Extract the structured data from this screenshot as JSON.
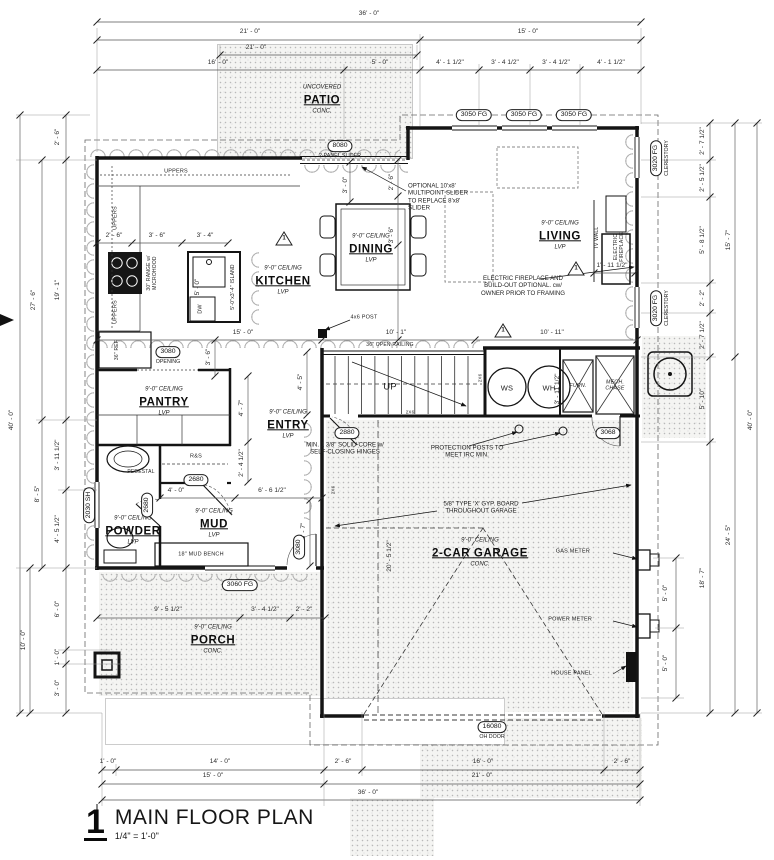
{
  "title_block": {
    "number": "1",
    "title": "MAIN FLOOR PLAN",
    "scale": "1/4\" = 1'-0\""
  },
  "plan": {
    "rooms": [
      {
        "id": "patio",
        "pre": "UNCOVERED",
        "label": "PATIO",
        "sub": "CONC.",
        "x": 322,
        "y": 100
      },
      {
        "id": "kitchen",
        "pre": "9'-0\" CEILING",
        "label": "KITCHEN",
        "sub": "LVP",
        "x": 283,
        "y": 281
      },
      {
        "id": "dining",
        "pre": "9'-0\" CEILING",
        "label": "DINING",
        "sub": "LVP",
        "x": 371,
        "y": 249
      },
      {
        "id": "living",
        "pre": "9'-0\" CEILING",
        "label": "LIVING",
        "sub": "LVP",
        "x": 560,
        "y": 236
      },
      {
        "id": "pantry",
        "pre": "9'-0\" CEILING",
        "label": "PANTRY",
        "sub": "LVP",
        "x": 164,
        "y": 402
      },
      {
        "id": "entry",
        "pre": "9'-0\" CEILING",
        "label": "ENTRY",
        "sub": "LVP",
        "x": 288,
        "y": 425
      },
      {
        "id": "powder",
        "pre": "9'-0\" CEILING",
        "label": "POWDER",
        "sub": "LVP",
        "x": 133,
        "y": 531
      },
      {
        "id": "mud",
        "pre": "9'-0\" CEILING",
        "label": "MUD",
        "sub": "LVP",
        "x": 214,
        "y": 524
      },
      {
        "id": "garage",
        "pre": "9'-0\" CEILING",
        "label": "2-CAR GARAGE",
        "sub": "CONC.",
        "x": 480,
        "y": 553
      },
      {
        "id": "porch",
        "pre": "9'-0\" CEILING",
        "label": "PORCH",
        "sub": "CONC.",
        "x": 213,
        "y": 640
      }
    ],
    "dimensions": [
      {
        "t": "36' - 0\"",
        "x": 369,
        "y": 14
      },
      {
        "t": "21' - 0\"",
        "x": 250,
        "y": 32
      },
      {
        "t": "15' - 0\"",
        "x": 528,
        "y": 32
      },
      {
        "t": "21' - 0\"",
        "x": 256,
        "y": 48
      },
      {
        "t": "16' - 0\"",
        "x": 218,
        "y": 63
      },
      {
        "t": "5' - 0\"",
        "x": 380,
        "y": 63
      },
      {
        "t": "4' - 1 1/2\"",
        "x": 450,
        "y": 63
      },
      {
        "t": "3' - 4 1/2\"",
        "x": 505,
        "y": 63
      },
      {
        "t": "3' - 4 1/2\"",
        "x": 556,
        "y": 63
      },
      {
        "t": "4' - 1 1/2\"",
        "x": 611,
        "y": 63
      },
      {
        "t": "1' - 0\"",
        "x": 108,
        "y": 762
      },
      {
        "t": "14' - 0\"",
        "x": 220,
        "y": 762
      },
      {
        "t": "2' - 6\"",
        "x": 343,
        "y": 762
      },
      {
        "t": "16' - 0\"",
        "x": 483,
        "y": 762
      },
      {
        "t": "2' - 6\"",
        "x": 622,
        "y": 762
      },
      {
        "t": "15' - 0\"",
        "x": 213,
        "y": 776
      },
      {
        "t": "21' - 0\"",
        "x": 482,
        "y": 776
      },
      {
        "t": "36' - 0\"",
        "x": 368,
        "y": 793
      },
      {
        "t": "2' - 6\"",
        "x": 58,
        "y": 137,
        "r": 1
      },
      {
        "t": "19' - 1\"",
        "x": 58,
        "y": 290,
        "r": 1
      },
      {
        "t": "27' - 6\"",
        "x": 34,
        "y": 300,
        "r": 1
      },
      {
        "t": "40' - 0\"",
        "x": 12,
        "y": 420,
        "r": 1
      },
      {
        "t": "3' - 11 1/2\"",
        "x": 58,
        "y": 455,
        "r": 1
      },
      {
        "t": "8' - 5\"",
        "x": 38,
        "y": 494,
        "r": 1
      },
      {
        "t": "4' - 5 1/2\"",
        "x": 58,
        "y": 529,
        "r": 1
      },
      {
        "t": "6' - 0\"",
        "x": 58,
        "y": 609,
        "r": 1
      },
      {
        "t": "1' - 0\"",
        "x": 58,
        "y": 657,
        "r": 1
      },
      {
        "t": "3' - 0\"",
        "x": 58,
        "y": 688,
        "r": 1
      },
      {
        "t": "10' - 0\"",
        "x": 24,
        "y": 640,
        "r": 1
      },
      {
        "t": "2' - 7 1/2\"",
        "x": 703,
        "y": 141,
        "r": 1
      },
      {
        "t": "2' - 5 1/2\"",
        "x": 703,
        "y": 178,
        "r": 1
      },
      {
        "t": "5' - 8 1/2\"",
        "x": 703,
        "y": 240,
        "r": 1
      },
      {
        "t": "2' - 2\"",
        "x": 703,
        "y": 298,
        "r": 1
      },
      {
        "t": "2' - 7 1/2\"",
        "x": 703,
        "y": 335,
        "r": 1
      },
      {
        "t": "15' - 7\"",
        "x": 729,
        "y": 240,
        "r": 1
      },
      {
        "t": "5' - 10\"",
        "x": 703,
        "y": 399,
        "r": 1
      },
      {
        "t": "18' - 7\"",
        "x": 703,
        "y": 578,
        "r": 1
      },
      {
        "t": "24' - 5\"",
        "x": 729,
        "y": 535,
        "r": 1
      },
      {
        "t": "40' - 0\"",
        "x": 751,
        "y": 420,
        "r": 1
      },
      {
        "t": "5' - 0\"",
        "x": 666,
        "y": 593,
        "r": 1
      },
      {
        "t": "5' - 0\"",
        "x": 666,
        "y": 663,
        "r": 1
      },
      {
        "t": "2' - 6\"",
        "x": 114,
        "y": 236
      },
      {
        "t": "3' - 6\"",
        "x": 157,
        "y": 236
      },
      {
        "t": "3' - 4\"",
        "x": 205,
        "y": 236
      },
      {
        "t": "5' - 0\"",
        "x": 198,
        "y": 287,
        "r": 1
      },
      {
        "t": "15' - 0\"",
        "x": 243,
        "y": 333
      },
      {
        "t": "10' - 1\"",
        "x": 396,
        "y": 333
      },
      {
        "t": "10' - 11\"",
        "x": 552,
        "y": 333
      },
      {
        "t": "3' - 6\"",
        "x": 209,
        "y": 357,
        "r": 1
      },
      {
        "t": "2' - 6\"",
        "x": 392,
        "y": 182,
        "r": 1
      },
      {
        "t": "3' - 6\"",
        "x": 392,
        "y": 235,
        "r": 1
      },
      {
        "t": "3' - 0\"",
        "x": 346,
        "y": 185,
        "r": 1
      },
      {
        "t": "4' - 7\"",
        "x": 242,
        "y": 408,
        "r": 1
      },
      {
        "t": "2' - 4 1/2\"",
        "x": 242,
        "y": 463,
        "r": 1
      },
      {
        "t": "4' - 5\"",
        "x": 301,
        "y": 382,
        "r": 1
      },
      {
        "t": "4' - 0\"",
        "x": 176,
        "y": 491
      },
      {
        "t": "6' - 6 1/2\"",
        "x": 272,
        "y": 491
      },
      {
        "t": "5' - 7\"",
        "x": 304,
        "y": 531,
        "r": 1
      },
      {
        "t": "1' - 11 1/2\"",
        "x": 612,
        "y": 266
      },
      {
        "t": "3' - 11 1/2\"",
        "x": 558,
        "y": 389,
        "r": 1
      },
      {
        "t": "20' - 5 1/2\"",
        "x": 390,
        "y": 556,
        "r": 1
      },
      {
        "t": "9' - 5 1/2\"",
        "x": 168,
        "y": 610
      },
      {
        "t": "3' - 4 1/2\"",
        "x": 265,
        "y": 610
      },
      {
        "t": "2' - 2\"",
        "x": 304,
        "y": 610
      }
    ],
    "tags": [
      {
        "t": "8080",
        "sub": "2-PANEL SLIDER",
        "x": 340,
        "y": 146
      },
      {
        "t": "3050 FG",
        "x": 474,
        "y": 115
      },
      {
        "t": "3050 FG",
        "x": 524,
        "y": 115
      },
      {
        "t": "3050 FG",
        "x": 574,
        "y": 115
      },
      {
        "t": "3020 FG",
        "sub": "CLERESTORY",
        "x": 656,
        "y": 158,
        "r": 1
      },
      {
        "t": "3020 FG",
        "sub": "CLERESTORY",
        "x": 656,
        "y": 308,
        "r": 1
      },
      {
        "t": "3080",
        "sub": "OPENING",
        "x": 168,
        "y": 352
      },
      {
        "t": "2880",
        "x": 347,
        "y": 433
      },
      {
        "t": "3068",
        "x": 608,
        "y": 433
      },
      {
        "t": "2680",
        "x": 196,
        "y": 480
      },
      {
        "t": "2680",
        "x": 147,
        "y": 505,
        "r": 1
      },
      {
        "t": "2030 SH",
        "x": 89,
        "y": 505,
        "r": 1
      },
      {
        "t": "3060 FG",
        "x": 240,
        "y": 585
      },
      {
        "t": "3080",
        "x": 299,
        "y": 547,
        "r": 1
      },
      {
        "t": "16080",
        "sub": "OH DOOR",
        "x": 492,
        "y": 727
      }
    ],
    "fixtures": [
      {
        "t": "UPPERS",
        "x": 176,
        "y": 172,
        "fs": 5.5
      },
      {
        "t": "UPPERS",
        "x": 116,
        "y": 218,
        "r": 1,
        "fs": 5.5
      },
      {
        "t": "UPPERS",
        "x": 116,
        "y": 312,
        "r": 1,
        "fs": 5.5
      },
      {
        "t": "30\" RANGE w/\nMICROHOOD",
        "x": 152,
        "y": 273,
        "r": 1,
        "fs": 5
      },
      {
        "t": "DW",
        "x": 201,
        "y": 309,
        "r": 1,
        "fs": 5.5
      },
      {
        "t": "5'-0\"x3'-4\" ISLAND",
        "x": 233,
        "y": 287,
        "r": 1,
        "fs": 5
      },
      {
        "t": "36\" REF",
        "x": 117,
        "y": 350,
        "r": 1,
        "fs": 5
      },
      {
        "t": "R&S",
        "x": 196,
        "y": 457,
        "fs": 5.5
      },
      {
        "t": "PEDESTAL",
        "x": 141,
        "y": 472,
        "fs": 5
      },
      {
        "t": "18\" MUD BENCH",
        "x": 201,
        "y": 555,
        "fs": 5.5
      },
      {
        "t": "WS",
        "x": 507,
        "y": 388,
        "fs": 7.5
      },
      {
        "t": "WH",
        "x": 549,
        "y": 388,
        "fs": 7.5
      },
      {
        "t": "FURN.",
        "x": 578,
        "y": 386,
        "fs": 5.3,
        "i": 1
      },
      {
        "t": "MECH.\nCHASE",
        "x": 615,
        "y": 386,
        "fs": 5.3,
        "i": 1
      },
      {
        "t": "UP",
        "x": 390,
        "y": 387,
        "fs": 9.5
      },
      {
        "t": "36\" OPEN RAILING",
        "x": 390,
        "y": 345,
        "fs": 5
      },
      {
        "t": "4x6 POST",
        "x": 364,
        "y": 318,
        "fs": 5.5
      },
      {
        "t": "TV WALL",
        "x": 597,
        "y": 238,
        "r": 1,
        "fs": 5
      },
      {
        "t": "ELECTRIC\nFIREPLACE",
        "x": 619,
        "y": 247,
        "r": 1,
        "fs": 5
      },
      {
        "t": "GAS METER",
        "x": 590,
        "y": 552,
        "fs": 5.5,
        "a": "r"
      },
      {
        "t": "POWER METER",
        "x": 592,
        "y": 620,
        "fs": 5.5,
        "a": "r"
      },
      {
        "t": "HOUSE PANEL",
        "x": 592,
        "y": 674,
        "fs": 5.5,
        "a": "r"
      },
      {
        "t": "2X6",
        "x": 480,
        "y": 378,
        "r": 1,
        "fs": 4.5
      },
      {
        "t": "2X6",
        "x": 333,
        "y": 490,
        "r": 1,
        "fs": 4.5
      },
      {
        "t": "2X6",
        "x": 410,
        "y": 412,
        "fs": 4.5
      }
    ],
    "notes": [
      {
        "t": "OPTIONAL 10'x8'\nMULTIPOINT SLIDER\nTO REPLACE 8'x8'\nSLIDER",
        "x": 408,
        "y": 197,
        "a": "l"
      },
      {
        "t": "ELECTRIC FIREPLACE AND\nBUILD-OUT OPTIONAL. cw/\nOWNER PRIOR TO FRAMING",
        "x": 523,
        "y": 286
      },
      {
        "t": "PROTECTION POSTS TO\nMEET IRC MIN.",
        "x": 467,
        "y": 452
      },
      {
        "t": "5/8\" TYPE 'X' GYP. BOARD\nTHROUGHOUT GARAGE",
        "x": 481,
        "y": 508
      },
      {
        "t": "MIN. 1 3/8\" SOLID-CORE w/\nSELF-CLOSING HINGES",
        "x": 345,
        "y": 449
      }
    ],
    "keynotes": [
      {
        "t": "1",
        "x": 284,
        "y": 240
      },
      {
        "t": "1",
        "x": 576,
        "y": 270
      },
      {
        "t": "1",
        "x": 503,
        "y": 332
      }
    ]
  }
}
